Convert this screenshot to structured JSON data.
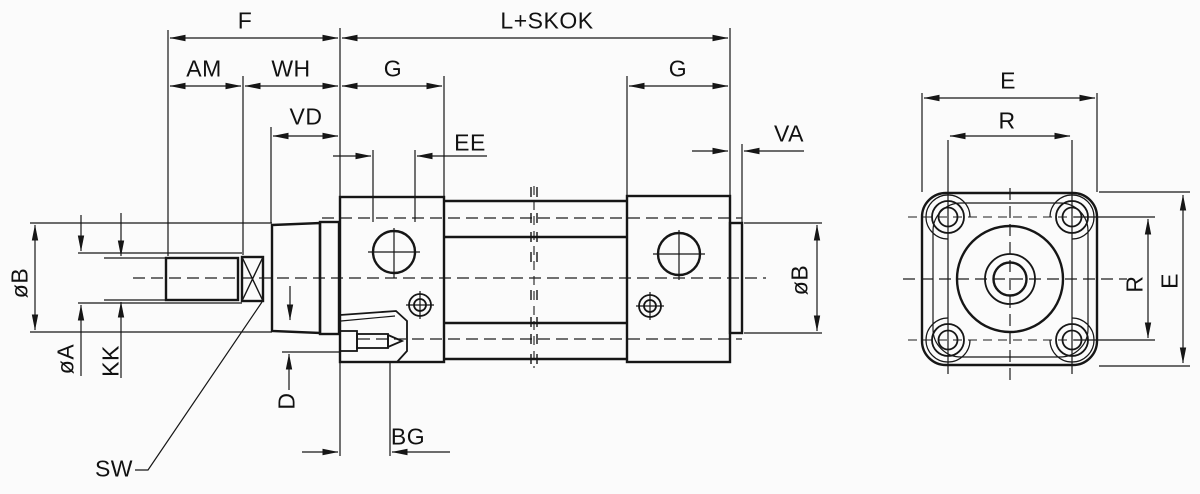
{
  "drawing": {
    "kind": "cylinder-dimension-diagram",
    "colors": {
      "line": "#161616",
      "background": "#fbfbfb"
    },
    "dimensions": {
      "F": "F",
      "L_SKOK": "L+SKOK",
      "AM": "AM",
      "WH": "WH",
      "G_left": "G",
      "G_right": "G",
      "VD": "VD",
      "EE": "EE",
      "VA": "VA",
      "BG": "BG",
      "SW": "SW",
      "D": "D",
      "KK": "KK",
      "dia_A": "øA",
      "dia_B_left": "øB",
      "dia_B_right": "øB",
      "E_top": "E",
      "R_top": "R",
      "R_side": "R",
      "E_side": "E"
    }
  }
}
